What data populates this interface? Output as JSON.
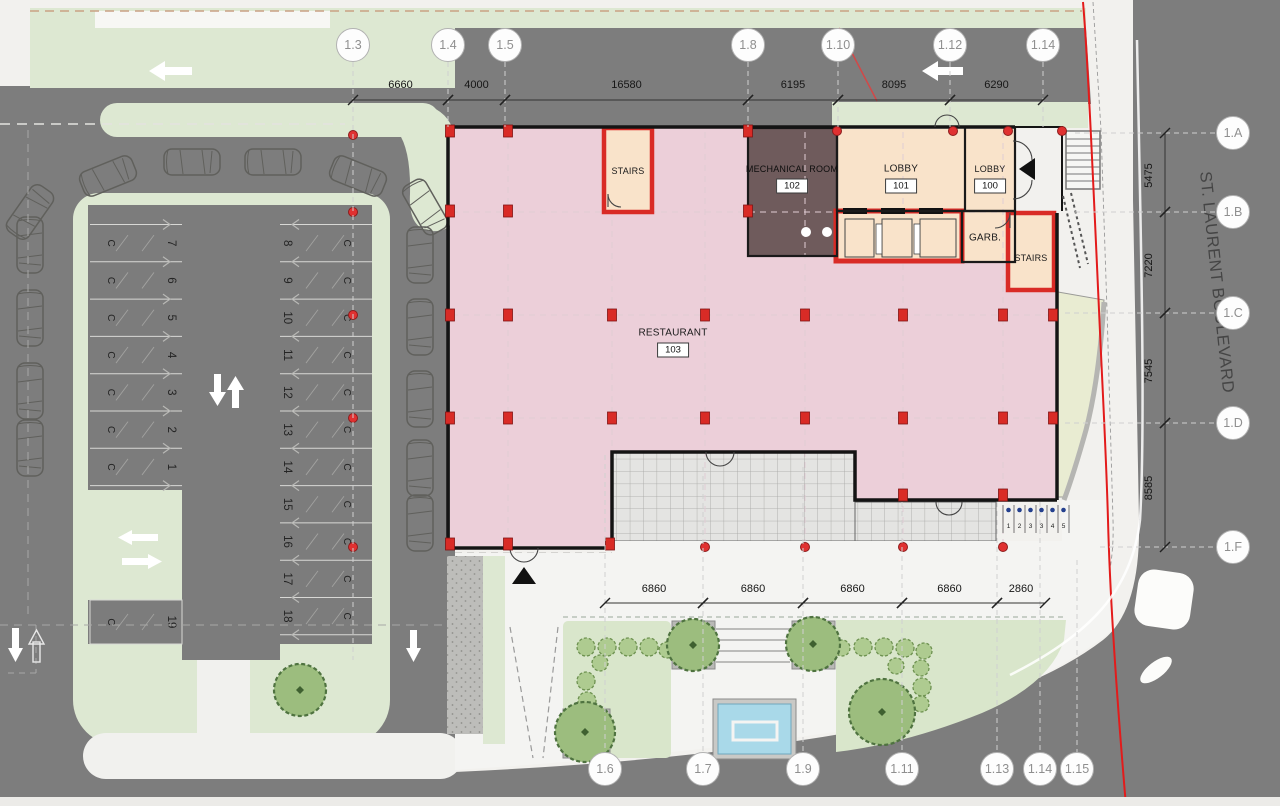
{
  "plan": {
    "street_label": "ST. LAURENT BOULEVARD",
    "rooms": {
      "stairs_upper": {
        "label": "STAIRS"
      },
      "mechanical": {
        "label": "MECHANICAL ROOM",
        "number": "102"
      },
      "lobby_main": {
        "label": "LOBBY",
        "number": "101"
      },
      "lobby_small": {
        "label": "LOBBY",
        "number": "100"
      },
      "garbage": {
        "label": "GARB."
      },
      "stairs_right": {
        "label": "STAIRS"
      },
      "restaurant": {
        "label": "RESTAURANT",
        "number": "103"
      }
    },
    "grid_bubbles": {
      "top": [
        {
          "label": "1.3",
          "x": 353
        },
        {
          "label": "1.4",
          "x": 448
        },
        {
          "label": "1.5",
          "x": 505
        },
        {
          "label": "1.8",
          "x": 748
        },
        {
          "label": "1.10",
          "x": 838
        },
        {
          "label": "1.12",
          "x": 950
        },
        {
          "label": "1.14",
          "x": 1043
        }
      ],
      "right": [
        {
          "label": "1.A",
          "y": 133
        },
        {
          "label": "1.B",
          "y": 212
        },
        {
          "label": "1.C",
          "y": 313
        },
        {
          "label": "1.D",
          "y": 423
        },
        {
          "label": "1.F",
          "y": 547
        }
      ],
      "bottom": [
        {
          "label": "1.6",
          "x": 605
        },
        {
          "label": "1.7",
          "x": 703
        },
        {
          "label": "1.9",
          "x": 803
        },
        {
          "label": "1.11",
          "x": 902
        },
        {
          "label": "1.13",
          "x": 997
        },
        {
          "label": "1.14",
          "x": 1040
        },
        {
          "label": "1.15",
          "x": 1077
        }
      ]
    },
    "dimensions": {
      "top": {
        "y": 100,
        "label_y": 88,
        "segments": [
          {
            "label": "6660",
            "from": 353,
            "to": 448
          },
          {
            "label": "4000",
            "from": 448,
            "to": 505
          },
          {
            "label": "16580",
            "from": 505,
            "to": 748
          },
          {
            "label": "6195",
            "from": 748,
            "to": 838
          },
          {
            "label": "8095",
            "from": 838,
            "to": 950
          },
          {
            "label": "6290",
            "from": 950,
            "to": 1043
          }
        ]
      },
      "right": {
        "x": 1165,
        "label_x": 1152,
        "segments": [
          {
            "label": "5475",
            "from": 133,
            "to": 212
          },
          {
            "label": "7220",
            "from": 212,
            "to": 313
          },
          {
            "label": "7545",
            "from": 313,
            "to": 423
          },
          {
            "label": "8585",
            "from": 423,
            "to": 547
          }
        ]
      },
      "bottom": {
        "y": 603,
        "label_y": 592,
        "segments": [
          {
            "label": "6860",
            "from": 605,
            "to": 703
          },
          {
            "label": "6860",
            "from": 703,
            "to": 803
          },
          {
            "label": "6860",
            "from": 803,
            "to": 902
          },
          {
            "label": "6860",
            "from": 902,
            "to": 997
          },
          {
            "label": "2860",
            "from": 997,
            "to": 1045
          }
        ]
      }
    },
    "parking": {
      "stall_mark": "C",
      "left_column": {
        "x1": 90,
        "x2": 182,
        "x_number": 168,
        "x_mark": 108,
        "y_start": 224.5,
        "pitch": 37.3,
        "numbers": [
          "7",
          "6",
          "5",
          "4",
          "3",
          "2",
          "1"
        ]
      },
      "right_column": {
        "x1": 280,
        "x2": 372,
        "x_number": 284,
        "x_mark": 344,
        "y_start": 224.5,
        "pitch": 37.3,
        "numbers": [
          "8",
          "9",
          "10",
          "11",
          "12",
          "13",
          "14",
          "15",
          "16",
          "17",
          "18"
        ]
      },
      "extra_stall": {
        "number": "19",
        "x1": 90,
        "x2": 182,
        "y1": 600,
        "y2": 644,
        "x_number": 168,
        "x_mark": 108
      }
    },
    "bike_stalls": {
      "x_start": 1003,
      "pitch": 11,
      "y_dot": 510,
      "y_num": 528,
      "numbers": [
        "1",
        "2",
        "3",
        "3",
        "4",
        "5"
      ]
    },
    "colors": {
      "asphalt": "#7d7d7d",
      "green": "#dde8d2",
      "lawn": "#d9e6cb",
      "pink": "#eccfd9",
      "brown": "#6f5b5c",
      "cream": "#f9e3ca",
      "red": "#d92b26",
      "red_line": "#e31b1b",
      "tile": "#e4e4e2",
      "wedge": "#e9ecd2",
      "water": "#a9d9e9"
    }
  }
}
